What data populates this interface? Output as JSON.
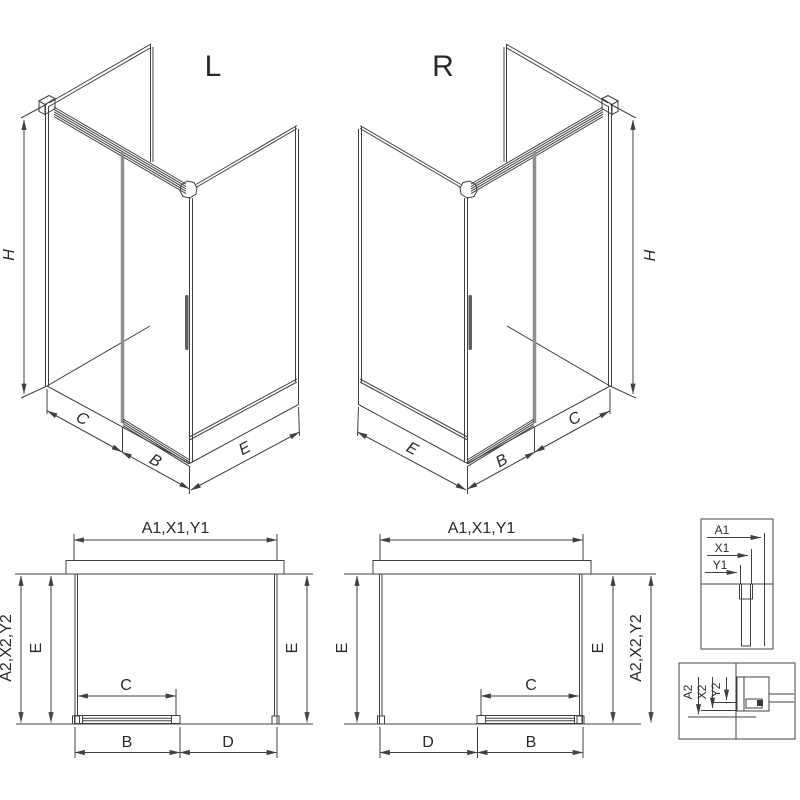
{
  "colors": {
    "line": "#404040",
    "text": "#2a2a2a",
    "thick_edge": "#8f8f8f",
    "background": "#ffffff"
  },
  "views": {
    "iso_left": {
      "label": "L",
      "dims": {
        "height": "H",
        "front_fixed": "C",
        "door": "B",
        "side": "E"
      }
    },
    "iso_right": {
      "label": "R",
      "dims": {
        "height": "H",
        "side": "E",
        "door": "B",
        "front_fixed": "C"
      }
    },
    "plan_left": {
      "dims": {
        "top_width": "A1,X1,Y1",
        "outer_depth": "A2,X2,Y2",
        "side_left": "E",
        "side_right": "E",
        "opening": "C",
        "door": "B",
        "fixed": "D"
      }
    },
    "plan_right": {
      "dims": {
        "top_width": "A1,X1,Y1",
        "outer_depth": "A2,X2,Y2",
        "side_left": "E",
        "side_right": "E",
        "opening": "C",
        "fixed": "D",
        "door": "B"
      }
    },
    "detail_width_options": {
      "labels": [
        "A1",
        "X1",
        "Y1"
      ]
    },
    "detail_depth_options": {
      "labels": [
        "A2",
        "X2",
        "Y2"
      ]
    }
  }
}
